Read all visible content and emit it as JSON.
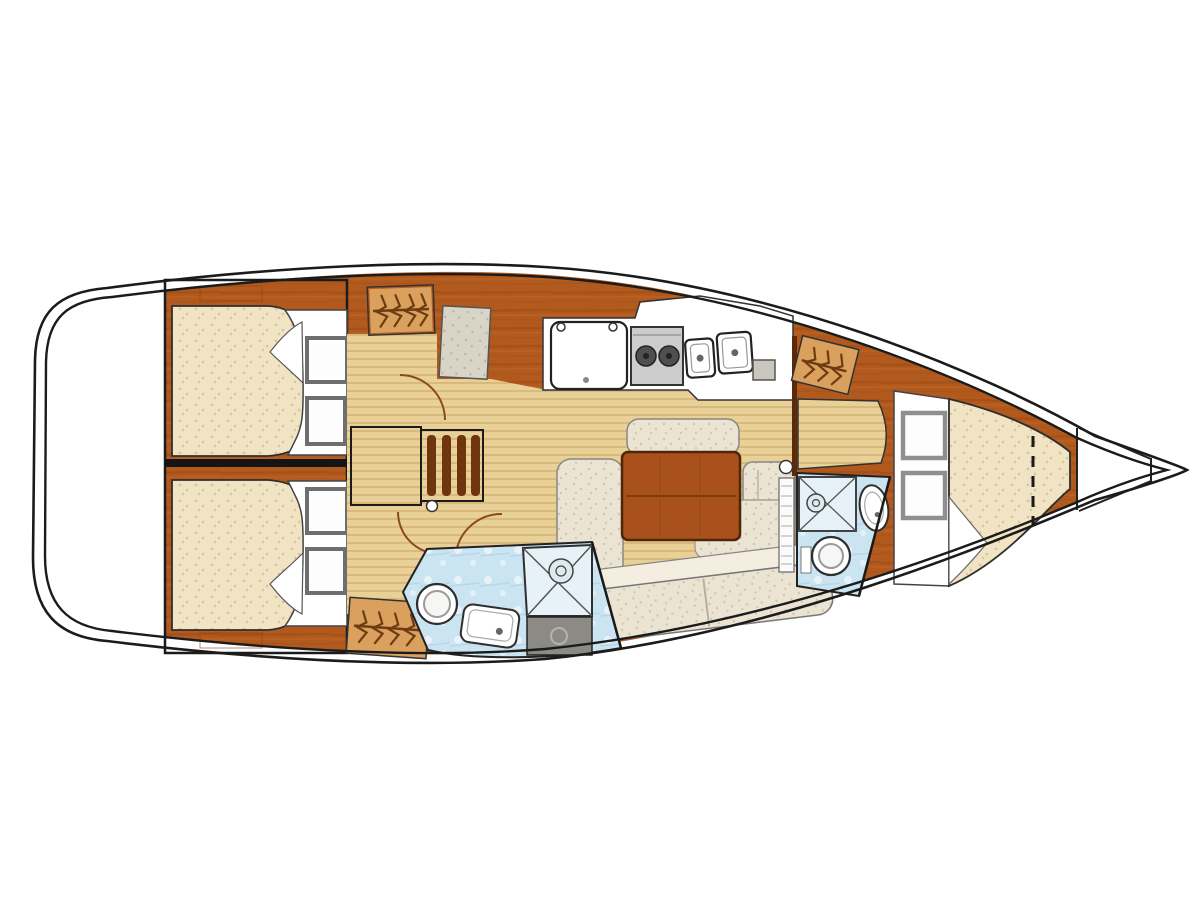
{
  "diagram": {
    "title": "Sailboat interior layout plan (top view, bow to the right)",
    "type": "boat-floor-plan",
    "rooms": [
      {
        "name": "cockpit",
        "position": "stern-left",
        "fixtures": []
      },
      {
        "name": "aft-cabin-upper",
        "fixtures": [
          "double-berth",
          "pillows",
          "turned-sheet"
        ]
      },
      {
        "name": "aft-cabin-lower",
        "fixtures": [
          "double-berth",
          "pillows",
          "turned-sheet"
        ]
      },
      {
        "name": "companionway",
        "fixtures": [
          "steps",
          "hanging-locker",
          "hanging-locker",
          "seat"
        ]
      },
      {
        "name": "galley",
        "fixtures": [
          "fridge",
          "two-burner-stove",
          "double-sink",
          "counter-hatch"
        ]
      },
      {
        "name": "saloon",
        "fixtures": [
          "table",
          "u-settee",
          "bench"
        ]
      },
      {
        "name": "aft-head",
        "fixtures": [
          "toilet",
          "sink",
          "shower-pan",
          "sump-box"
        ]
      },
      {
        "name": "forward-head",
        "fixtures": [
          "toilet",
          "oval-sink",
          "shower-pan",
          "louver-door"
        ]
      },
      {
        "name": "forward-cabin",
        "fixtures": [
          "v-berth",
          "pillows",
          "vanity-seat",
          "hanging-locker"
        ]
      },
      {
        "name": "bow",
        "fixtures": [
          "anchor-locker"
        ]
      }
    ],
    "colors": {
      "hull_line": "#1b1b1b",
      "wood_base": "#b25a1e",
      "wood_streak": "#974814",
      "wood_light": "#c96f2e",
      "wood_dark": "#7c3a0e",
      "wood_mid": "#a8511c",
      "step_wood": "#b5611f",
      "slat_dark": "#6f350e",
      "locker_bg": "#d9a05e",
      "hanger": "#6d3c12",
      "sole": "#e9d096",
      "sole_line": "#c3a05c",
      "mattress": "#f1e4c4",
      "mattress_dot": "#d9c49a",
      "settee": "#ebe4d2",
      "settee_dot": "#cfc6b0",
      "settee_back": "#f3eee0",
      "seat_gray": "#d8d4c6",
      "seat_gray_dot": "#b9b5a7",
      "head_floor": "#cbe4f1",
      "head_floor_line": "#a9cee3",
      "shower_pan": "#e7f1f8",
      "sump_gray": "#8b8a85",
      "stove_gray": "#cccccc",
      "burner": "#4f4f4f",
      "white": "#ffffff"
    }
  }
}
